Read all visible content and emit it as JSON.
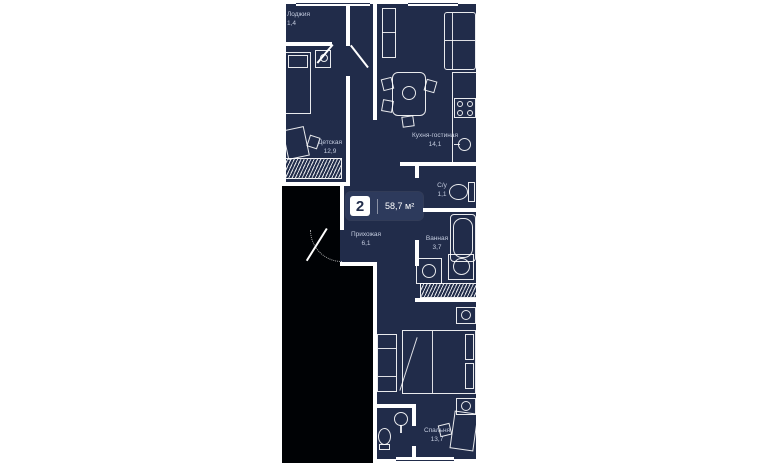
{
  "plan": {
    "type": "apartment-floor-plan",
    "badge": {
      "rooms_count": "2",
      "area_label": "58,7 м²"
    },
    "rooms": [
      {
        "id": "loggia",
        "name": "Лоджия",
        "area": "1,4"
      },
      {
        "id": "children-room",
        "name": "Детская",
        "area": "12,9"
      },
      {
        "id": "kitchen-living",
        "name": "Кухня-гостиная",
        "area": "14,1"
      },
      {
        "id": "wc",
        "name": "С/у",
        "area": "1,1"
      },
      {
        "id": "hallway",
        "name": "Прихожая",
        "area": "6,1"
      },
      {
        "id": "bathroom",
        "name": "Ванная",
        "area": "3,7"
      },
      {
        "id": "bedroom",
        "name": "Спальня",
        "area": "13,7"
      }
    ],
    "colors": {
      "page_bg": "#ffffff",
      "apartment_bg": "#212c4a",
      "outside_bg": "#000205",
      "walls": "#ffffff",
      "label_text": "#c3cbde",
      "badge_bg": "#2d3a5c"
    },
    "icons": {
      "window-icon": "white-bar",
      "single-bed-icon": "outlined-rect-with-pillow",
      "desk-icon": "rotated-rect",
      "chair-icon": "small-rect",
      "wardrobe-icon": "hatched-rect",
      "dining-table-icon": "rounded-rect",
      "sofa-icon": "sectioned-rect",
      "kitchen-cabinet-icon": "tall-rect",
      "stove-icon": "rect-with-4-burners",
      "kitchen-sink-icon": "rect-with-circle",
      "toilet-icon": "oval-with-tank",
      "bathtub-icon": "rounded-rect-with-inner-oval",
      "vanity-sink-icon": "rect-with-circle",
      "washing-machine-icon": "square-with-drum-circle",
      "double-bed-icon": "rect-with-two-pillows",
      "nightstand-icon": "square-with-lamp-circle",
      "pedestal-sink-icon": "circle-with-stem",
      "entrance-door-icon": "door-leaf-with-swing-arc",
      "interior-door-icon": "diagonal-leaf"
    }
  }
}
